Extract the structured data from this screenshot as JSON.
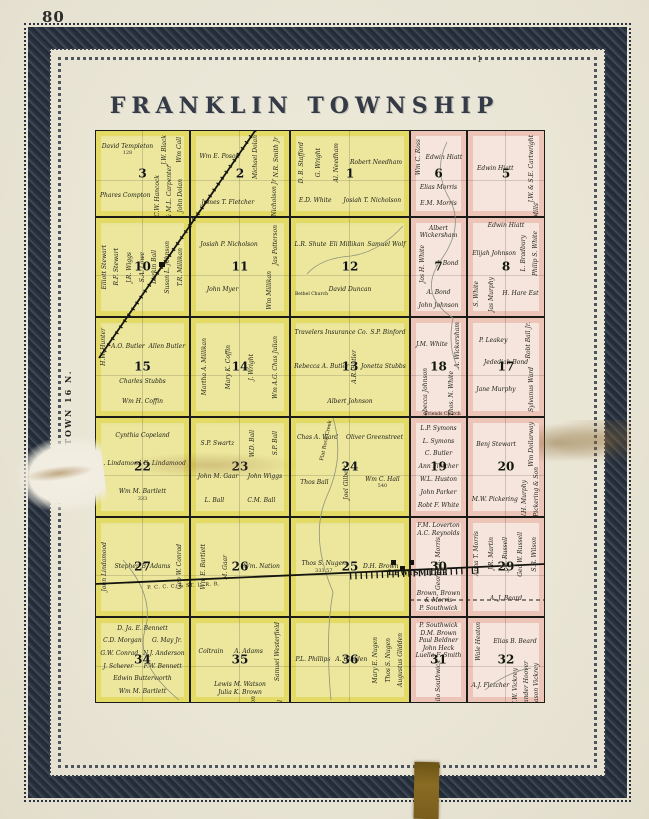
{
  "page": {
    "number": "80",
    "top_mark": "1",
    "title": "FRANKLIN TOWNSHIP",
    "side_label": "TOWN 16 N.",
    "colors": {
      "yellow_region": "#ece79c",
      "pink_region": "#f5e5dc",
      "border_band": "#2a3340",
      "ribbon": "#8a6b24"
    }
  },
  "map": {
    "labels": [
      {
        "text": "LEWISVILLE",
        "x": 293,
        "y": 438,
        "size": 7,
        "bold": true,
        "spacing": 1,
        "rot": 0
      },
      {
        "text": "P. C. C. C. & ST. L. R. R.",
        "x": 52,
        "y": 455,
        "size": 5,
        "bold": false,
        "spacing": 0.5,
        "rot": -3
      },
      {
        "text": "Flat Rock Creek",
        "x": 224,
        "y": 330,
        "size": 5,
        "bold": false,
        "spacing": 0,
        "rot": -78
      },
      {
        "text": "Bethel Church",
        "x": 200,
        "y": 162,
        "size": 4.5,
        "bold": false,
        "spacing": 0,
        "rot": 0
      },
      {
        "text": "Friends Church",
        "x": 330,
        "y": 282,
        "size": 4.5,
        "bold": false,
        "spacing": 0,
        "rot": 0
      }
    ],
    "sections": [
      {
        "num": "3",
        "region": "yellow",
        "col": "A",
        "row": 1,
        "owners": [
          {
            "n": "David Templeton",
            "a": "128"
          },
          {
            "n": "J.W. Black",
            "rot": true
          },
          {
            "n": "Wm Call",
            "rot": true
          },
          {
            "n": "Phares Compton"
          },
          {
            "n": "C.W. Hancock",
            "rot": true
          },
          {
            "n": "B. & M.L. Carpenter",
            "rot": true
          },
          {
            "n": "John Dolan",
            "rot": true
          }
        ]
      },
      {
        "num": "2",
        "region": "yellow",
        "col": "B",
        "row": 1,
        "owners": [
          {
            "n": "Wm E. Poson"
          },
          {
            "n": "Michael Dolan",
            "rot": true
          },
          {
            "n": "N.R. Smith Jr",
            "rot": true
          },
          {
            "n": "James T. Fletcher"
          },
          {
            "n": "J.P. Nicholson Jr",
            "rot": true
          }
        ]
      },
      {
        "num": "1",
        "region": "yellow",
        "col": "C",
        "row": 1,
        "owners": [
          {
            "n": "D. B. Stafford",
            "rot": true
          },
          {
            "n": "G. Wright",
            "rot": true
          },
          {
            "n": "Al. Needham",
            "rot": true
          },
          {
            "n": "Robert Needham"
          },
          {
            "n": "E.D. White"
          },
          {
            "n": "Josiah T. Nicholson"
          }
        ]
      },
      {
        "num": "6",
        "region": "pink",
        "col": "D",
        "row": 1,
        "owners": [
          {
            "n": "Wm C. Ross",
            "rot": true
          },
          {
            "n": "Edwin Hiatt"
          },
          {
            "n": "Elias Morris"
          },
          {
            "n": "E.M. Morris"
          }
        ]
      },
      {
        "num": "5",
        "region": "pink",
        "col": "E",
        "row": 1,
        "owners": [
          {
            "n": "Edwin Hiatt"
          },
          {
            "n": "J.W. & S.E. Cartwright",
            "rot": true
          },
          {
            "n": "Est. Cynthia Sands"
          },
          {
            "n": "Ed. J.D. Mills",
            "rot": true
          },
          {
            "n": "Jos L. Bradbury",
            "rot": true
          },
          {
            "n": "Sid Stigleman",
            "rot": true
          }
        ]
      },
      {
        "num": "10",
        "region": "yellow",
        "col": "A",
        "row": 2,
        "owners": [
          {
            "n": "Elliott Stewart",
            "rot": true
          },
          {
            "n": "R.F. Stewart",
            "rot": true
          },
          {
            "n": "J.R. Wiggs",
            "rot": true
          },
          {
            "n": "S.A. Lowe",
            "rot": true
          },
          {
            "n": "Lurkin Ball",
            "rot": true
          },
          {
            "n": "Susan L. Johnson",
            "rot": true
          },
          {
            "n": "T.R. Millikan",
            "rot": true
          }
        ]
      },
      {
        "num": "11",
        "region": "yellow",
        "col": "B",
        "row": 2,
        "owners": [
          {
            "n": "Josiah P. Nicholson"
          },
          {
            "n": "Jas Patterson",
            "rot": true
          },
          {
            "n": "John Myer"
          },
          {
            "n": "Wm Millikan",
            "rot": true
          }
        ]
      },
      {
        "num": "12",
        "region": "yellow",
        "col": "C",
        "row": 2,
        "owners": [
          {
            "n": "L.R. Shute"
          },
          {
            "n": "Eli Millikan"
          },
          {
            "n": "Samuel Wolf"
          },
          {
            "n": "David Duncan"
          }
        ]
      },
      {
        "num": "7",
        "region": "pink",
        "col": "D",
        "row": 2,
        "owners": [
          {
            "n": "Albert Wickersham"
          },
          {
            "n": "Jos H. White",
            "rot": true
          },
          {
            "n": "J. Bond"
          },
          {
            "n": "A. Bond"
          },
          {
            "n": "John Johnson"
          }
        ]
      },
      {
        "num": "8",
        "region": "pink",
        "col": "E",
        "row": 2,
        "owners": [
          {
            "n": "Edwin Hiatt"
          },
          {
            "n": "Elijah Johnson"
          },
          {
            "n": "L. Bradbury",
            "rot": true
          },
          {
            "n": "Philip S. White",
            "rot": true
          },
          {
            "n": "S. White",
            "rot": true
          },
          {
            "n": "Jas Murphy",
            "rot": true
          },
          {
            "n": "H. Hare Est"
          }
        ]
      },
      {
        "num": "15",
        "region": "yellow",
        "col": "A",
        "row": 3,
        "owners": [
          {
            "n": "H.W. Hunter",
            "rot": true
          },
          {
            "n": "A.O. Butler"
          },
          {
            "n": "Allen Butler"
          },
          {
            "n": "Charles Stubbs"
          },
          {
            "n": "Wm H. Coffin"
          }
        ]
      },
      {
        "num": "14",
        "region": "yellow",
        "col": "B",
        "row": 3,
        "owners": [
          {
            "n": "Martha A. Millikan",
            "rot": true
          },
          {
            "n": "Mary K. Coffin",
            "rot": true
          },
          {
            "n": "J. Wright",
            "rot": true
          },
          {
            "n": "Wm A.G. Chas Julian",
            "rot": true
          }
        ]
      },
      {
        "num": "13",
        "region": "yellow",
        "col": "C",
        "row": 3,
        "owners": [
          {
            "n": "Travelers Insurance Co."
          },
          {
            "n": "S.P. Binford"
          },
          {
            "n": "Rebecca A. Butler"
          },
          {
            "n": "A.R. Butler",
            "rot": true
          },
          {
            "n": "Jonetta Stubbs"
          },
          {
            "n": "Albert Johnson"
          }
        ]
      },
      {
        "num": "18",
        "region": "pink",
        "col": "D",
        "row": 3,
        "owners": [
          {
            "n": "J.M. White"
          },
          {
            "n": "A. Wickersham",
            "rot": true
          },
          {
            "n": "Rebecca Johnson",
            "rot": true
          },
          {
            "n": "Thos. N. White",
            "rot": true
          },
          {
            "n": "Wm A. Macy"
          },
          {
            "n": "J.J. Gilbert"
          },
          {
            "n": "Wm White",
            "rot": true
          }
        ]
      },
      {
        "num": "17",
        "region": "pink",
        "col": "E",
        "row": 3,
        "owners": [
          {
            "n": "P. Leakey"
          },
          {
            "n": "Robt Ball Jr.",
            "rot": true
          },
          {
            "n": "Jedediah Bond"
          },
          {
            "n": "Jane Murphy"
          },
          {
            "n": "Sylvanus Ward",
            "rot": true
          }
        ]
      },
      {
        "num": "22",
        "region": "yellow",
        "col": "A",
        "row": 4,
        "owners": [
          {
            "n": "Cynthia Copeland"
          },
          {
            "n": "A. Lindamood"
          },
          {
            "n": "E. Lindamood"
          },
          {
            "n": "Wm M. Bartlett",
            "a": "333"
          }
        ]
      },
      {
        "num": "23",
        "region": "yellow",
        "col": "B",
        "row": 4,
        "owners": [
          {
            "n": "S.P. Swartz"
          },
          {
            "n": "W.D. Ball",
            "rot": true
          },
          {
            "n": "S.P. Ball",
            "rot": true
          },
          {
            "n": "John M. Gaar"
          },
          {
            "n": "John Wiggs"
          },
          {
            "n": "L. Ball"
          },
          {
            "n": "C.M. Ball"
          }
        ]
      },
      {
        "num": "24",
        "region": "yellow",
        "col": "C",
        "row": 4,
        "owners": [
          {
            "n": "Chas A. Ward"
          },
          {
            "n": "Oliver Greenstreet"
          },
          {
            "n": "Thos Ball"
          },
          {
            "n": "Joel Gilbert",
            "rot": true
          },
          {
            "n": "Wm C. Hall",
            "a": "540"
          }
        ]
      },
      {
        "num": "19",
        "region": "pink",
        "col": "D",
        "row": 4,
        "owners": [
          {
            "n": "L.P. Symons"
          },
          {
            "n": "L. Symons"
          },
          {
            "n": "C. Butler"
          },
          {
            "n": "Ann Fletcher"
          },
          {
            "n": "W.L. Huston"
          },
          {
            "n": "John Parker"
          },
          {
            "n": "Robt F. White"
          }
        ]
      },
      {
        "num": "20",
        "region": "pink",
        "col": "E",
        "row": 4,
        "owners": [
          {
            "n": "Benj Stewart"
          },
          {
            "n": "Wm Dollarway",
            "rot": true
          },
          {
            "n": "M.W. Pickering"
          },
          {
            "n": "W.H. Murphy",
            "rot": true
          },
          {
            "n": "M.W. Pickering & Son",
            "rot": true
          },
          {
            "n": "Robt Hall"
          }
        ]
      },
      {
        "num": "27",
        "region": "yellow",
        "col": "A",
        "row": 5,
        "owners": [
          {
            "n": "John Lindamood",
            "rot": true
          },
          {
            "n": "Stephen B. Adams"
          },
          {
            "n": "Geo W. Conrad",
            "rot": true
          }
        ]
      },
      {
        "num": "26",
        "region": "yellow",
        "col": "B",
        "row": 5,
        "owners": [
          {
            "n": "Wm E. Bartlett",
            "rot": true
          },
          {
            "n": "M. Gaar",
            "rot": true
          },
          {
            "n": "Wm. Nation"
          }
        ]
      },
      {
        "num": "25",
        "region": "yellow",
        "col": "C",
        "row": 5,
        "owners": [
          {
            "n": "Thos S. Nugen",
            "a": "333.57"
          },
          {
            "n": "D.H. Brown"
          }
        ]
      },
      {
        "num": "30",
        "region": "pink",
        "col": "D",
        "row": 5,
        "owners": [
          {
            "n": "F.M. Loverton"
          },
          {
            "n": "A.C. Reynolds"
          },
          {
            "n": "George R. Morris",
            "rot": true
          },
          {
            "n": "Brown, Brown & Morris"
          },
          {
            "n": "P. Southwick"
          }
        ]
      },
      {
        "num": "29",
        "region": "pink",
        "col": "E",
        "row": 5,
        "owners": [
          {
            "n": "Anna T. Morris",
            "rot": true
          },
          {
            "n": "J.R. Martin",
            "rot": true
          },
          {
            "n": "J.N. Russell",
            "rot": true
          },
          {
            "n": "Geo W. Russell",
            "rot": true
          },
          {
            "n": "S.R. Wilson",
            "rot": true
          },
          {
            "n": "A. J. Beard"
          }
        ]
      },
      {
        "num": "34",
        "region": "yellow",
        "col": "A",
        "row": 6,
        "owners": [
          {
            "n": "D. Ja. E. Bennett"
          },
          {
            "n": "C.D. Morgan"
          },
          {
            "n": "G. May Jr."
          },
          {
            "n": "G.W. Conrad"
          },
          {
            "n": "N.J. Anderson"
          },
          {
            "n": "J. Scherer"
          },
          {
            "n": "F.W. Bennett"
          },
          {
            "n": "Edwin Butterworth"
          },
          {
            "n": "Wm M. Bartlett"
          }
        ]
      },
      {
        "num": "35",
        "region": "yellow",
        "col": "B",
        "row": 6,
        "owners": [
          {
            "n": "Coltrain"
          },
          {
            "n": "A. Adams"
          },
          {
            "n": "Samuel Westerfield",
            "rot": true
          },
          {
            "n": "Lewis M. Watson"
          },
          {
            "n": "Julia K. Brown"
          },
          {
            "n": "Luella K. Brown"
          },
          {
            "n": "Sarah E.E. Watson",
            "rot": true
          },
          {
            "n": "Geo W. Martin",
            "rot": true
          },
          {
            "n": "Mary E. Russell",
            "rot": true
          }
        ]
      },
      {
        "num": "36",
        "region": "yellow",
        "col": "C",
        "row": 6,
        "owners": [
          {
            "n": "P.L. Phillips"
          },
          {
            "n": "A. Glidden"
          },
          {
            "n": "Mary E. Nugen",
            "rot": true
          },
          {
            "n": "Thos S. Nugen",
            "rot": true
          },
          {
            "n": "Augustus Glidden",
            "rot": true
          }
        ]
      },
      {
        "num": "31",
        "region": "pink",
        "col": "D",
        "row": 6,
        "owners": [
          {
            "n": "P. Southwick"
          },
          {
            "n": "D.M. Brown"
          },
          {
            "n": "Paul Beldner"
          },
          {
            "n": "John Heck"
          },
          {
            "n": "Luella F. Smith"
          },
          {
            "n": "Philo Southwick",
            "rot": true
          }
        ]
      },
      {
        "num": "32",
        "region": "pink",
        "col": "E",
        "row": 6,
        "owners": [
          {
            "n": "Wale Heaton",
            "rot": true
          },
          {
            "n": "Elias B. Beard"
          },
          {
            "n": "A.J. Fletcher"
          },
          {
            "n": "J.W. Vickrey",
            "rot": true
          },
          {
            "n": "Leander Hoover",
            "rot": true
          },
          {
            "n": "Mason Vickrey",
            "rot": true
          }
        ]
      }
    ]
  }
}
